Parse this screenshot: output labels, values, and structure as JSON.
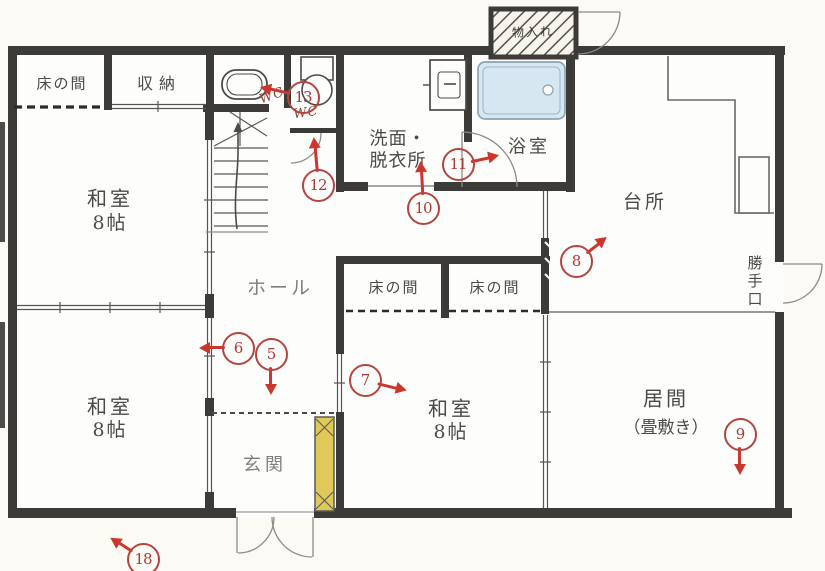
{
  "document": {
    "type": "japanese-floor-plan-scan",
    "colors": {
      "annotation_red": "#b5443e",
      "arrow_red": "#cb372c",
      "wall": "#3d3b38",
      "bathtub_fill": "#d7e7f2",
      "cabinet_yellow": "#dec959",
      "paper": "#fbfaf4"
    }
  },
  "rooms": {
    "tokonoma_nw": {
      "label": "床の間"
    },
    "closet": {
      "label": "収納"
    },
    "washitsu_nw": {
      "label": "和室",
      "sublabel": "8帖"
    },
    "washitsu_sw": {
      "label": "和室",
      "sublabel": "8帖"
    },
    "hall": {
      "label": "ホール"
    },
    "genkan": {
      "label": "玄関"
    },
    "washroom": {
      "label": "洗面・",
      "label2": "脱衣所"
    },
    "bathroom": {
      "label": "浴室"
    },
    "kitchen": {
      "label": "台所"
    },
    "katteguchi": {
      "label": "勝手口"
    },
    "living": {
      "label": "居間",
      "sublabel": "（畳敷き）"
    },
    "washitsu_c": {
      "label": "和室",
      "sublabel": "8帖"
    },
    "tokonoma_c1": {
      "label": "床の間"
    },
    "tokonoma_c2": {
      "label": "床の間"
    },
    "outbuilding": {
      "label": "物入れ"
    }
  },
  "fixtures": [
    "bathtub",
    "toilet",
    "toilet",
    "washbasin",
    "staircase-up",
    "kitchen-counter",
    "shoe-cabinet",
    "hatched-storage-box"
  ],
  "wc_marks": [
    {
      "text": "WC",
      "x": 272,
      "y": 96,
      "angle": -20
    },
    {
      "text": "WC",
      "x": 306,
      "y": 113,
      "angle": -8
    }
  ],
  "annotations": [
    {
      "num": "5",
      "x": 271,
      "y": 354,
      "angle": 90,
      "len": 40
    },
    {
      "num": "6",
      "x": 238,
      "y": 348,
      "angle": 180,
      "len": 38
    },
    {
      "num": "7",
      "x": 365,
      "y": 380,
      "angle": 14,
      "len": 42
    },
    {
      "num": "8",
      "x": 576,
      "y": 261,
      "angle": -38,
      "len": 38
    },
    {
      "num": "9",
      "x": 740,
      "y": 434,
      "angle": 90,
      "len": 40
    },
    {
      "num": "10",
      "x": 423,
      "y": 208,
      "angle": -93,
      "len": 46
    },
    {
      "num": "11",
      "x": 458,
      "y": 164,
      "angle": -12,
      "len": 41
    },
    {
      "num": "12",
      "x": 318,
      "y": 185,
      "angle": -95,
      "len": 47
    },
    {
      "num": "13",
      "x": 303,
      "y": 97,
      "angle": 193,
      "len": 43
    },
    {
      "num": "18",
      "x": 143,
      "y": 559,
      "angle": 213,
      "len": 38
    }
  ]
}
